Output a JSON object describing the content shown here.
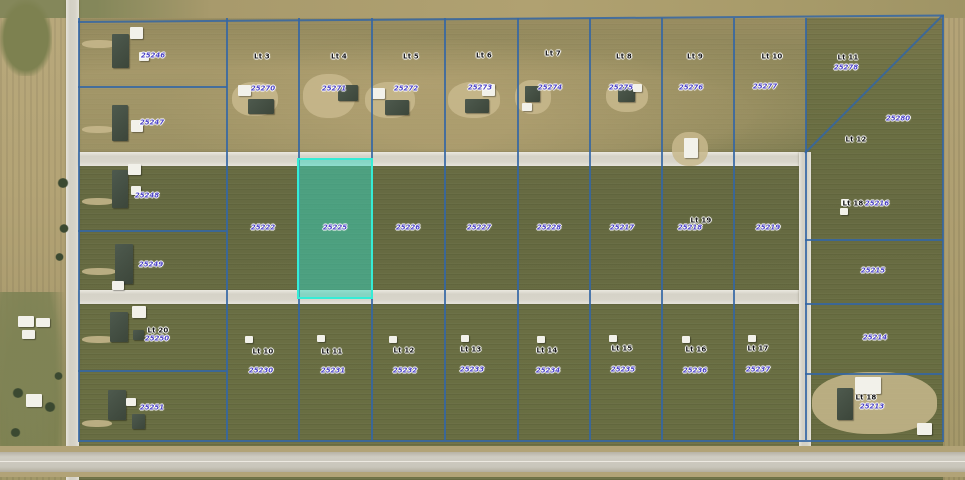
{
  "map": {
    "type": "aerial-parcel-map",
    "colors": {
      "boundary_line": "#3466a4",
      "highlight_fill": "#35d6be",
      "highlight_border": "#35ecd6",
      "parcel_number_text": "#4b42c6",
      "lot_label_text": "#141414"
    },
    "selected_parcel": {
      "number": "25225"
    }
  },
  "lot_labels": [
    {
      "text": "Lt 3",
      "x": 262,
      "y": 57
    },
    {
      "text": "Lt 4",
      "x": 339,
      "y": 57
    },
    {
      "text": "Lt 5",
      "x": 411,
      "y": 57
    },
    {
      "text": "Lt 6",
      "x": 484,
      "y": 56
    },
    {
      "text": "Lt 7",
      "x": 553,
      "y": 54
    },
    {
      "text": "Lt 8",
      "x": 624,
      "y": 57
    },
    {
      "text": "Lt 9",
      "x": 695,
      "y": 57
    },
    {
      "text": "Lt 10",
      "x": 772,
      "y": 57
    },
    {
      "text": "Lt 11",
      "x": 848,
      "y": 58
    },
    {
      "text": "Lt 12",
      "x": 856,
      "y": 140
    },
    {
      "text": "Lt 19",
      "x": 701,
      "y": 221
    },
    {
      "text": "Lt 18",
      "x": 853,
      "y": 204
    },
    {
      "text": "Lt 20",
      "x": 158,
      "y": 331
    },
    {
      "text": "Lt 10",
      "x": 263,
      "y": 352
    },
    {
      "text": "Lt 11",
      "x": 332,
      "y": 352
    },
    {
      "text": "Lt 12",
      "x": 404,
      "y": 351
    },
    {
      "text": "Lt 13",
      "x": 471,
      "y": 350
    },
    {
      "text": "Lt 14",
      "x": 547,
      "y": 351
    },
    {
      "text": "Lt 15",
      "x": 622,
      "y": 349
    },
    {
      "text": "Lt 16",
      "x": 696,
      "y": 350
    },
    {
      "text": "Lt 17",
      "x": 758,
      "y": 349
    },
    {
      "text": "Lt 18",
      "x": 866,
      "y": 398
    }
  ],
  "parcel_numbers": [
    {
      "text": "25246",
      "x": 153,
      "y": 56
    },
    {
      "text": "25247",
      "x": 152,
      "y": 123
    },
    {
      "text": "25248",
      "x": 147,
      "y": 196
    },
    {
      "text": "25249",
      "x": 151,
      "y": 265
    },
    {
      "text": "25250",
      "x": 157,
      "y": 339
    },
    {
      "text": "25251",
      "x": 152,
      "y": 408
    },
    {
      "text": "25270",
      "x": 263,
      "y": 89
    },
    {
      "text": "25271",
      "x": 334,
      "y": 89
    },
    {
      "text": "25272",
      "x": 406,
      "y": 89
    },
    {
      "text": "25273",
      "x": 480,
      "y": 88
    },
    {
      "text": "25274",
      "x": 550,
      "y": 88
    },
    {
      "text": "25275",
      "x": 621,
      "y": 88
    },
    {
      "text": "25276",
      "x": 691,
      "y": 88
    },
    {
      "text": "25277",
      "x": 765,
      "y": 87
    },
    {
      "text": "25278",
      "x": 846,
      "y": 68
    },
    {
      "text": "25280",
      "x": 898,
      "y": 119
    },
    {
      "text": "25222",
      "x": 263,
      "y": 228
    },
    {
      "text": "25225",
      "x": 335,
      "y": 228,
      "highlighted": true
    },
    {
      "text": "25226",
      "x": 408,
      "y": 228
    },
    {
      "text": "25227",
      "x": 479,
      "y": 228
    },
    {
      "text": "25228",
      "x": 549,
      "y": 228
    },
    {
      "text": "25217",
      "x": 622,
      "y": 228
    },
    {
      "text": "25218",
      "x": 690,
      "y": 228
    },
    {
      "text": "25219",
      "x": 768,
      "y": 228
    },
    {
      "text": "25216",
      "x": 877,
      "y": 204
    },
    {
      "text": "25215",
      "x": 873,
      "y": 271
    },
    {
      "text": "25214",
      "x": 875,
      "y": 338
    },
    {
      "text": "25213",
      "x": 872,
      "y": 407
    },
    {
      "text": "25230",
      "x": 261,
      "y": 371
    },
    {
      "text": "25231",
      "x": 333,
      "y": 371
    },
    {
      "text": "25232",
      "x": 405,
      "y": 371
    },
    {
      "text": "25233",
      "x": 472,
      "y": 370
    },
    {
      "text": "25234",
      "x": 548,
      "y": 371
    },
    {
      "text": "25235",
      "x": 623,
      "y": 370
    },
    {
      "text": "25236",
      "x": 695,
      "y": 371
    },
    {
      "text": "25237",
      "x": 758,
      "y": 370
    }
  ]
}
